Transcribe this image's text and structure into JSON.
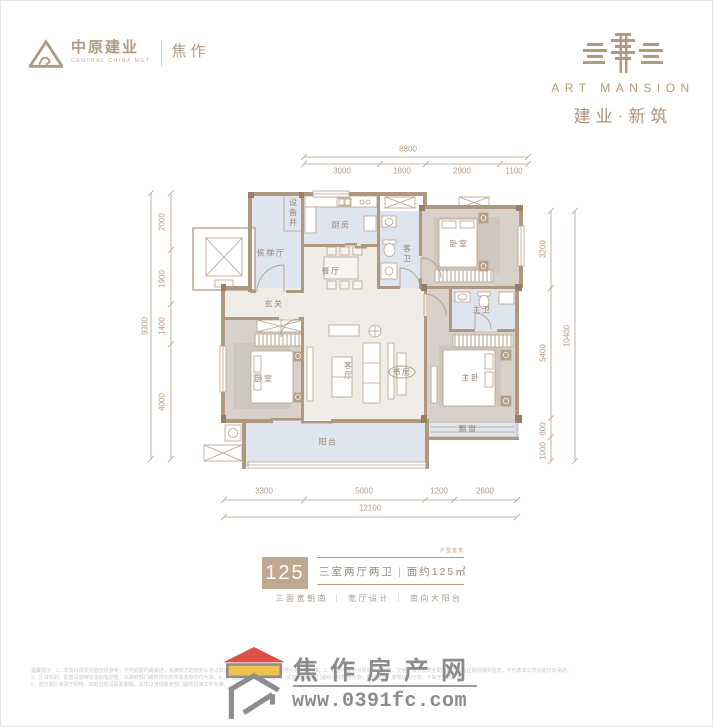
{
  "brand": {
    "company": "中原建业",
    "company_en": "CENTRAL CHINA MGT",
    "city": "焦作",
    "mansion_en": "ART MANSION",
    "mansion_cn": "建业·新筑"
  },
  "plan": {
    "rooms": {
      "shaft": "设备井",
      "elevator_hall": "侯梯厅",
      "kitchen": "厨房",
      "dining": "餐厅",
      "guest_bath": "客卫",
      "bedroom_tr": "卧室",
      "foyer": "玄关",
      "bedroom_bl": "卧室",
      "living": "客厅",
      "study": "书房",
      "master_bath": "主卫",
      "master_bedroom": "主卧",
      "bay_window": "飘窗",
      "balcony": "阳台"
    },
    "dims": {
      "top": {
        "total": "8800",
        "segments": [
          "3000",
          "1800",
          "2900",
          "1100"
        ]
      },
      "left": {
        "total": "9300",
        "segments": [
          "2000",
          "1900",
          "1400",
          "4000"
        ]
      },
      "right": {
        "total": "10400",
        "segments": [
          "3200",
          "5400",
          "800",
          "1000"
        ]
      },
      "bottom": {
        "total": "12100",
        "segments": [
          "3300",
          "5000",
          "1200",
          "2600"
        ]
      }
    }
  },
  "info": {
    "unit_number": "125",
    "watermark": "户型鉴赏",
    "layout": "三室两厅两卫",
    "divider": "|",
    "area": "面约125㎡",
    "features": "三面宽朝南 ｜ 宽厅设计 ｜ 南向大阳台"
  },
  "footer": {
    "site_name": "焦作房产网",
    "site_url": "www.0391fc.com",
    "disclaimer_1": "温馨提示：1、本资料相关内容仅供参考，不构成要约或承诺，买卖双方的权利义务以双方签订的商品房买卖合同及附件等协议为准。2、本宣传资料对项目周边环境、交通、教育及商业配套的介绍旨在提供相关信息，不代表本公司对此作出承诺。",
    "disclaimer_2": "3、区域规划、配套设施等信息如有调整，以政府部门最终规划文件及实际交付为准。4、户型图中面积为建筑面积，实际以测绘部门最终测绘报告为准；图中家具、家电仅为示意，不属于交付标准。",
    "disclaimer_3": "5、部分图片来源于网络，如有侵权请联系删除。具体以当地政府部门最终批准文件为准。"
  }
}
